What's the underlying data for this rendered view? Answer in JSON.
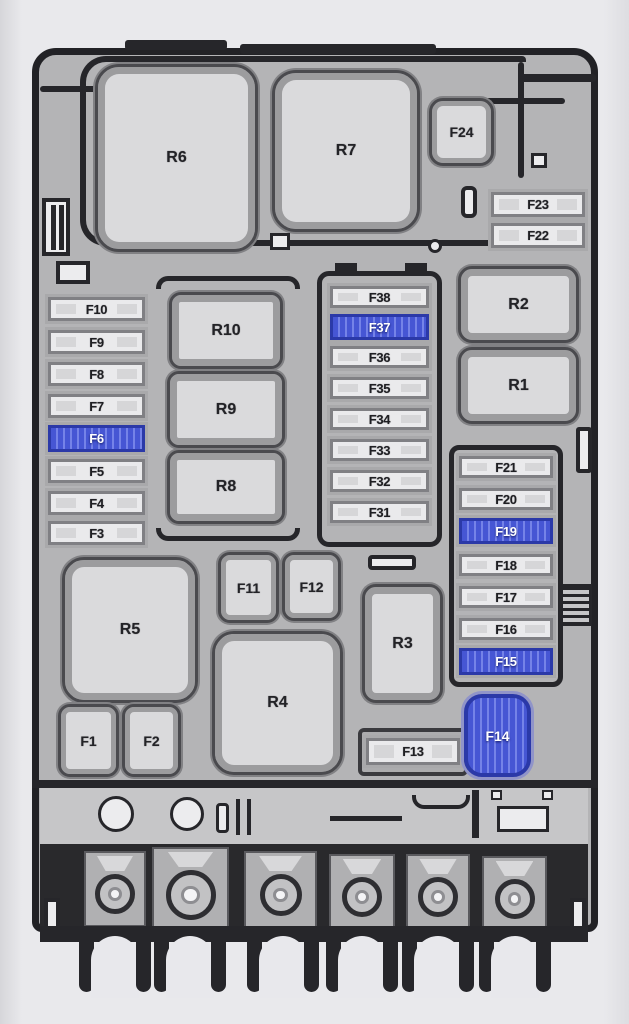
{
  "diagram": {
    "kind": "fuse-box-layout",
    "highlight_color": "#4656d4",
    "highlighted_fuses": [
      "F6",
      "F14",
      "F15",
      "F19",
      "F37"
    ],
    "bottom_strip": {
      "terminal_count": 6,
      "mount_hole_count": 2
    }
  },
  "relays": {
    "r1": {
      "label": "R1"
    },
    "r2": {
      "label": "R2"
    },
    "r3": {
      "label": "R3"
    },
    "r4": {
      "label": "R4"
    },
    "r5": {
      "label": "R5"
    },
    "r6": {
      "label": "R6"
    },
    "r7": {
      "label": "R7"
    },
    "r8": {
      "label": "R8"
    },
    "r9": {
      "label": "R9"
    },
    "r10": {
      "label": "R10"
    }
  },
  "fuses": {
    "f1": {
      "label": "F1",
      "highlighted": false
    },
    "f2": {
      "label": "F2",
      "highlighted": false
    },
    "f3": {
      "label": "F3",
      "highlighted": false
    },
    "f4": {
      "label": "F4",
      "highlighted": false
    },
    "f5": {
      "label": "F5",
      "highlighted": false
    },
    "f6": {
      "label": "F6",
      "highlighted": true
    },
    "f7": {
      "label": "F7",
      "highlighted": false
    },
    "f8": {
      "label": "F8",
      "highlighted": false
    },
    "f9": {
      "label": "F9",
      "highlighted": false
    },
    "f10": {
      "label": "F10",
      "highlighted": false
    },
    "f11": {
      "label": "F11",
      "highlighted": false
    },
    "f12": {
      "label": "F12",
      "highlighted": false
    },
    "f13": {
      "label": "F13",
      "highlighted": false
    },
    "f14": {
      "label": "F14",
      "highlighted": true
    },
    "f15": {
      "label": "F15",
      "highlighted": true
    },
    "f16": {
      "label": "F16",
      "highlighted": false
    },
    "f17": {
      "label": "F17",
      "highlighted": false
    },
    "f18": {
      "label": "F18",
      "highlighted": false
    },
    "f19": {
      "label": "F19",
      "highlighted": true
    },
    "f20": {
      "label": "F20",
      "highlighted": false
    },
    "f21": {
      "label": "F21",
      "highlighted": false
    },
    "f22": {
      "label": "F22",
      "highlighted": false
    },
    "f23": {
      "label": "F23",
      "highlighted": false
    },
    "f24": {
      "label": "F24",
      "highlighted": false
    },
    "f31": {
      "label": "F31",
      "highlighted": false
    },
    "f32": {
      "label": "F32",
      "highlighted": false
    },
    "f33": {
      "label": "F33",
      "highlighted": false
    },
    "f34": {
      "label": "F34",
      "highlighted": false
    },
    "f35": {
      "label": "F35",
      "highlighted": false
    },
    "f36": {
      "label": "F36",
      "highlighted": false
    },
    "f37": {
      "label": "F37",
      "highlighted": true
    },
    "f38": {
      "label": "F38",
      "highlighted": false
    }
  }
}
